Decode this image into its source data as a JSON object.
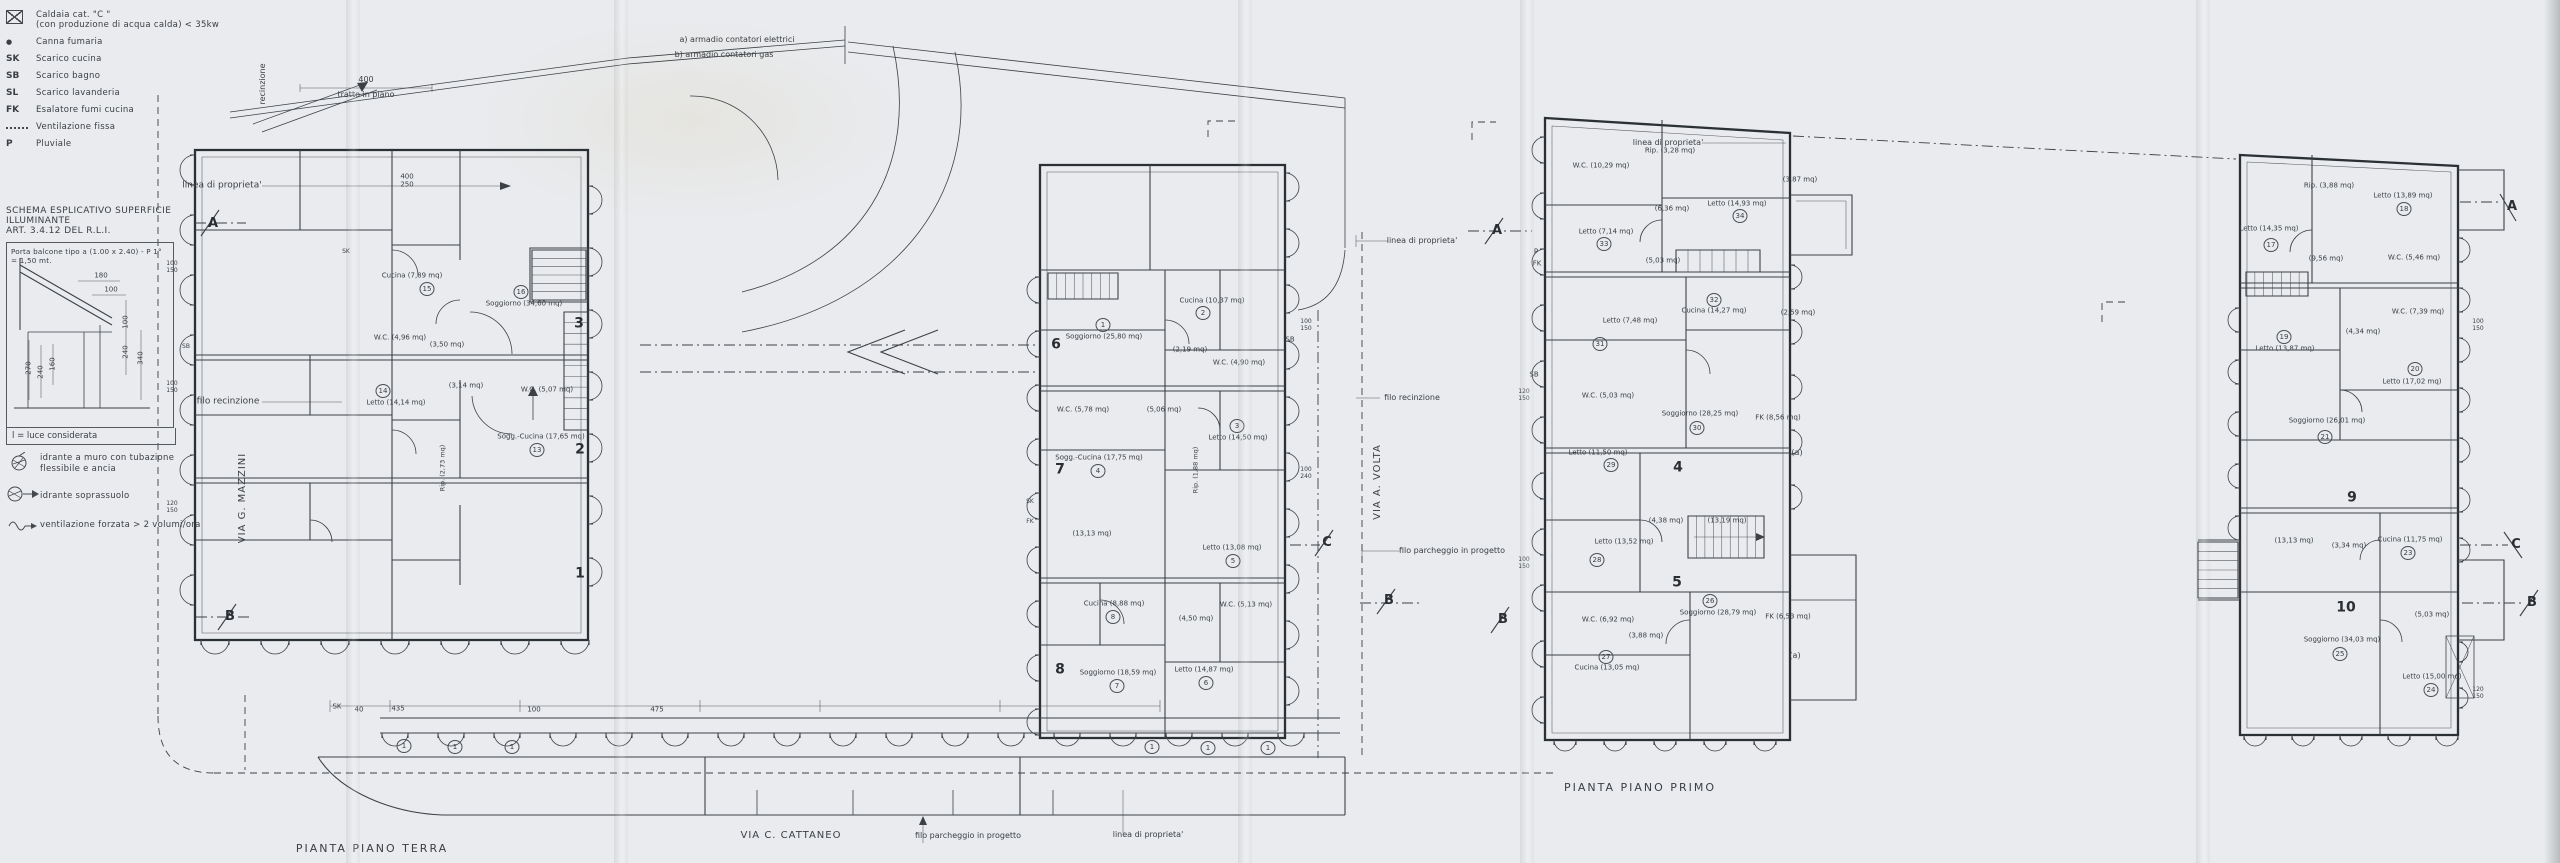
{
  "document": {
    "type": "scanned architectural floor plan drawing",
    "paper_color": "#e9ebee",
    "ink_color": "#3c4146"
  },
  "plan_titles": {
    "ground": "PIANTA PIANO TERRA",
    "first": "PIANTA PIANO PRIMO"
  },
  "legend": {
    "items": [
      {
        "icon": "boiler-box",
        "label": "Caldaia cat. \"C \"",
        "label2": "(con produzione di acqua calda) < 35kw"
      },
      {
        "icon": "flue-dot",
        "label": "Canna fumaria"
      },
      {
        "icon": "SK",
        "label": "Scarico cucina"
      },
      {
        "icon": "SB",
        "label": "Scarico bagno"
      },
      {
        "icon": "SL",
        "label": "Scarico lavanderia"
      },
      {
        "icon": "FK",
        "label": "Esalatore fumi cucina"
      },
      {
        "icon": "dotted-leader",
        "label": "Ventilazione fissa"
      },
      {
        "icon": "P",
        "label": "Pluviale"
      }
    ],
    "extras": [
      {
        "icon": "wall-hydrant",
        "label": "idrante a muro con tubazione",
        "label2": "flessibile e ancia"
      },
      {
        "icon": "ground-hydrant",
        "label": "idrante soprassuolo"
      },
      {
        "icon": "forced-vent",
        "label": "ventilazione forzata > 2 volumi/ora"
      }
    ]
  },
  "schema": {
    "title1": "SCHEMA ESPLICATIVO SUPERFICIE ILLUMINANTE",
    "title2": "ART. 3.4.12 DEL R.L.I.",
    "note1": "Porta balcone tipo a (1.00 x 2.40) - P 1°",
    "note2": "= 1,50 mt.",
    "caption": "l = luce considerata"
  },
  "labels": [
    {
      "t": "linea di proprieta'",
      "x": 222,
      "y": 186,
      "fs": 9,
      "n": "property-line-label"
    },
    {
      "t": "recinzione",
      "x": 263,
      "y": 84,
      "fs": 8,
      "r": -90
    },
    {
      "t": "400",
      "x": 366,
      "y": 80,
      "fs": 8
    },
    {
      "t": "tratto in piano",
      "x": 366,
      "y": 95,
      "fs": 8
    },
    {
      "t": "filo recinzione",
      "x": 228,
      "y": 402,
      "fs": 9,
      "n": "fence-line-label"
    },
    {
      "t": "VIA G. MAZZINI",
      "x": 243,
      "y": 498,
      "fs": 10,
      "r": -90,
      "sp": 1,
      "n": "street-label"
    },
    {
      "t": "A",
      "x": 213,
      "y": 224,
      "fs": 13,
      "b": 1,
      "n": "section-marker"
    },
    {
      "t": "B",
      "x": 230,
      "y": 617,
      "fs": 13,
      "b": 1,
      "n": "section-marker"
    },
    {
      "t": "PIANTA PIANO TERRA",
      "x": 372,
      "y": 849,
      "fs": 11,
      "sp": 2,
      "n": "plan-title-ground"
    },
    {
      "t": "VIA C. CATTANEO",
      "x": 791,
      "y": 836,
      "fs": 10,
      "sp": 1,
      "n": "street-label"
    },
    {
      "t": "filo parcheggio in progetto",
      "x": 968,
      "y": 836,
      "fs": 8
    },
    {
      "t": "linea di proprieta'",
      "x": 1148,
      "y": 835,
      "fs": 8
    },
    {
      "t": "a)  armadio contatori elettrici",
      "x": 737,
      "y": 40,
      "fs": 8,
      "n": "note-armadio-elettrici"
    },
    {
      "t": "b)  armadio contatori gas",
      "x": 724,
      "y": 55,
      "fs": 8,
      "n": "note-armadio-gas"
    },
    {
      "t": "400",
      "x": 407,
      "y": 177,
      "fs": 7
    },
    {
      "t": "250",
      "x": 407,
      "y": 185,
      "fs": 7
    },
    {
      "t": "SK",
      "x": 337,
      "y": 707,
      "fs": 7
    },
    {
      "t": "40",
      "x": 359,
      "y": 710,
      "fs": 7
    },
    {
      "t": "435",
      "x": 398,
      "y": 709,
      "fs": 7
    },
    {
      "t": "100",
      "x": 534,
      "y": 710,
      "fs": 7
    },
    {
      "t": "475",
      "x": 657,
      "y": 710,
      "fs": 7
    },
    {
      "t": "3",
      "x": 579,
      "y": 324,
      "fs": 14,
      "b": 1,
      "n": "unit-number"
    },
    {
      "t": "2",
      "x": 580,
      "y": 450,
      "fs": 14,
      "b": 1,
      "n": "unit-number"
    },
    {
      "t": "1",
      "x": 580,
      "y": 574,
      "fs": 14,
      "b": 1,
      "n": "unit-number"
    },
    {
      "t": "6",
      "x": 1056,
      "y": 345,
      "fs": 14,
      "b": 1,
      "n": "unit-number"
    },
    {
      "t": "7",
      "x": 1060,
      "y": 470,
      "fs": 14,
      "b": 1,
      "n": "unit-number"
    },
    {
      "t": "8",
      "x": 1060,
      "y": 670,
      "fs": 14,
      "b": 1,
      "n": "unit-number"
    },
    {
      "t": "4",
      "x": 1678,
      "y": 468,
      "fs": 14,
      "b": 1,
      "n": "unit-number"
    },
    {
      "t": "5",
      "x": 1677,
      "y": 583,
      "fs": 14,
      "b": 1,
      "n": "unit-number"
    },
    {
      "t": "9",
      "x": 2352,
      "y": 498,
      "fs": 14,
      "b": 1,
      "n": "unit-number"
    },
    {
      "t": "10",
      "x": 2346,
      "y": 608,
      "fs": 14,
      "b": 1,
      "n": "unit-number"
    },
    {
      "t": "Cucina (7,89 mq)",
      "x": 412,
      "y": 276,
      "fs": 7
    },
    {
      "t": "15",
      "x": 427,
      "y": 289,
      "ci": 1
    },
    {
      "t": "Soggiorno (34,60 mq)",
      "x": 524,
      "y": 304,
      "fs": 7
    },
    {
      "t": "16",
      "x": 521,
      "y": 292,
      "ci": 1
    },
    {
      "t": "W.C. (4,96 mq)",
      "x": 400,
      "y": 338,
      "fs": 7
    },
    {
      "t": "(3,50 mq)",
      "x": 447,
      "y": 345,
      "fs": 7
    },
    {
      "t": "Letto (14,14 mq)",
      "x": 396,
      "y": 403,
      "fs": 7
    },
    {
      "t": "14",
      "x": 383,
      "y": 391,
      "ci": 1
    },
    {
      "t": "(3,14 mq)",
      "x": 466,
      "y": 386,
      "fs": 7
    },
    {
      "t": "W.C. (5,07 mq)",
      "x": 547,
      "y": 390,
      "fs": 7
    },
    {
      "t": "Sogg.-Cucina (17,65 mq)",
      "x": 541,
      "y": 437,
      "fs": 7
    },
    {
      "t": "13",
      "x": 537,
      "y": 450,
      "ci": 1
    },
    {
      "t": "Rip. (2,73 mq)",
      "x": 443,
      "y": 468,
      "fs": 6.5,
      "r": -90
    },
    {
      "t": "Soggiorno (25,80 mq)",
      "x": 1104,
      "y": 337,
      "fs": 7
    },
    {
      "t": "1",
      "x": 1103,
      "y": 325,
      "ci": 1
    },
    {
      "t": "Cucina (10,37 mq)",
      "x": 1212,
      "y": 301,
      "fs": 7
    },
    {
      "t": "2",
      "x": 1203,
      "y": 313,
      "ci": 1
    },
    {
      "t": "(2,19 mq)",
      "x": 1190,
      "y": 350,
      "fs": 7
    },
    {
      "t": "W.C. (4,90 mq)",
      "x": 1239,
      "y": 363,
      "fs": 7
    },
    {
      "t": "W.C. (5,78 mq)",
      "x": 1083,
      "y": 410,
      "fs": 7
    },
    {
      "t": "(5,06 mq)",
      "x": 1164,
      "y": 410,
      "fs": 7
    },
    {
      "t": "Letto (14,50 mq)",
      "x": 1238,
      "y": 438,
      "fs": 7
    },
    {
      "t": "3",
      "x": 1237,
      "y": 426,
      "ci": 1
    },
    {
      "t": "Sogg.-Cucina (17,75 mq)",
      "x": 1099,
      "y": 458,
      "fs": 7
    },
    {
      "t": "4",
      "x": 1098,
      "y": 471,
      "ci": 1
    },
    {
      "t": "Rip. (1,88 mq)",
      "x": 1196,
      "y": 470,
      "fs": 6.5,
      "r": -90
    },
    {
      "t": "(13,13 mq)",
      "x": 1092,
      "y": 534,
      "fs": 7
    },
    {
      "t": "Letto (13,08 mq)",
      "x": 1232,
      "y": 548,
      "fs": 7
    },
    {
      "t": "5",
      "x": 1233,
      "y": 561,
      "ci": 1
    },
    {
      "t": "Cucina (8,88 mq)",
      "x": 1114,
      "y": 604,
      "fs": 7
    },
    {
      "t": "8",
      "x": 1113,
      "y": 617,
      "ci": 1
    },
    {
      "t": "W.C. (5,13 mq)",
      "x": 1246,
      "y": 605,
      "fs": 7
    },
    {
      "t": "(4,50 mq)",
      "x": 1196,
      "y": 619,
      "fs": 7
    },
    {
      "t": "Soggiorno (18,59 mq)",
      "x": 1118,
      "y": 673,
      "fs": 7
    },
    {
      "t": "7",
      "x": 1117,
      "y": 686,
      "ci": 1
    },
    {
      "t": "Letto (14,87 mq)",
      "x": 1204,
      "y": 670,
      "fs": 7
    },
    {
      "t": "6",
      "x": 1206,
      "y": 683,
      "ci": 1
    },
    {
      "t": "W.C. (10,29 mq)",
      "x": 1601,
      "y": 166,
      "fs": 7
    },
    {
      "t": "Rip. (3,28 mq)",
      "x": 1670,
      "y": 151,
      "fs": 7
    },
    {
      "t": "Letto (14,93 mq)",
      "x": 1737,
      "y": 204,
      "fs": 7
    },
    {
      "t": "34",
      "x": 1740,
      "y": 216,
      "ci": 1
    },
    {
      "t": "Letto (7,14 mq)",
      "x": 1606,
      "y": 232,
      "fs": 7
    },
    {
      "t": "33",
      "x": 1604,
      "y": 244,
      "ci": 1
    },
    {
      "t": "(6,36 mq)",
      "x": 1672,
      "y": 209,
      "fs": 7
    },
    {
      "t": "(3,87 mq)",
      "x": 1800,
      "y": 180,
      "fs": 7
    },
    {
      "t": "(5,03 mq)",
      "x": 1663,
      "y": 261,
      "fs": 7
    },
    {
      "t": "Letto (7,48 mq)",
      "x": 1630,
      "y": 321,
      "fs": 7
    },
    {
      "t": "31",
      "x": 1600,
      "y": 344,
      "ci": 1
    },
    {
      "t": "Cucina (14,27 mq)",
      "x": 1714,
      "y": 311,
      "fs": 7
    },
    {
      "t": "32",
      "x": 1714,
      "y": 300,
      "ci": 1
    },
    {
      "t": "(2,59 mq)",
      "x": 1798,
      "y": 313,
      "fs": 7
    },
    {
      "t": "Soggiorno (28,25 mq)",
      "x": 1700,
      "y": 414,
      "fs": 7
    },
    {
      "t": "30",
      "x": 1697,
      "y": 428,
      "ci": 1
    },
    {
      "t": "W.C. (5,03 mq)",
      "x": 1608,
      "y": 396,
      "fs": 7
    },
    {
      "t": "FK (8,56 mq)",
      "x": 1778,
      "y": 418,
      "fs": 7
    },
    {
      "t": "Letto (11,50 mq)",
      "x": 1598,
      "y": 453,
      "fs": 7
    },
    {
      "t": "29",
      "x": 1611,
      "y": 465,
      "ci": 1
    },
    {
      "t": "Letto (13,52 mq)",
      "x": 1624,
      "y": 542,
      "fs": 7
    },
    {
      "t": "28",
      "x": 1597,
      "y": 560,
      "ci": 1
    },
    {
      "t": "(13,19 mq)",
      "x": 1727,
      "y": 521,
      "fs": 7
    },
    {
      "t": "(4,38 mq)",
      "x": 1666,
      "y": 521,
      "fs": 7
    },
    {
      "t": "Soggiorno (28,79 mq)",
      "x": 1718,
      "y": 613,
      "fs": 7
    },
    {
      "t": "26",
      "x": 1710,
      "y": 601,
      "ci": 1
    },
    {
      "t": "W.C. (6,92 mq)",
      "x": 1608,
      "y": 620,
      "fs": 7
    },
    {
      "t": "(3,88 mq)",
      "x": 1646,
      "y": 636,
      "fs": 7
    },
    {
      "t": "Cucina (13,05 mq)",
      "x": 1607,
      "y": 668,
      "fs": 7
    },
    {
      "t": "27",
      "x": 1606,
      "y": 657,
      "ci": 1
    },
    {
      "t": "FK (6,53 mq)",
      "x": 1788,
      "y": 617,
      "fs": 7
    },
    {
      "t": "(a)",
      "x": 1797,
      "y": 453,
      "fs": 8
    },
    {
      "t": "(a)",
      "x": 1795,
      "y": 656,
      "fs": 8
    },
    {
      "t": "Letto (14,35 mq)",
      "x": 2269,
      "y": 229,
      "fs": 7
    },
    {
      "t": "17",
      "x": 2271,
      "y": 245,
      "ci": 1
    },
    {
      "t": "Rip. (3,88 mq)",
      "x": 2329,
      "y": 186,
      "fs": 7
    },
    {
      "t": "Letto (13,89 mq)",
      "x": 2403,
      "y": 196,
      "fs": 7
    },
    {
      "t": "18",
      "x": 2404,
      "y": 209,
      "ci": 1
    },
    {
      "t": "W.C. (5,46 mq)",
      "x": 2414,
      "y": 258,
      "fs": 7
    },
    {
      "t": "(9,56 mq)",
      "x": 2326,
      "y": 259,
      "fs": 7
    },
    {
      "t": "Letto (13,87 mq)",
      "x": 2285,
      "y": 349,
      "fs": 7
    },
    {
      "t": "19",
      "x": 2284,
      "y": 337,
      "ci": 1
    },
    {
      "t": "W.C. (7,39 mq)",
      "x": 2418,
      "y": 312,
      "fs": 7
    },
    {
      "t": "(4,34 mq)",
      "x": 2363,
      "y": 332,
      "fs": 7
    },
    {
      "t": "Letto (17,02 mq)",
      "x": 2412,
      "y": 382,
      "fs": 7
    },
    {
      "t": "20",
      "x": 2415,
      "y": 369,
      "ci": 1
    },
    {
      "t": "Soggiorno (26,01 mq)",
      "x": 2327,
      "y": 421,
      "fs": 7
    },
    {
      "t": "21",
      "x": 2325,
      "y": 437,
      "ci": 1
    },
    {
      "t": "Cucina (11,75 mq)",
      "x": 2410,
      "y": 540,
      "fs": 7
    },
    {
      "t": "23",
      "x": 2408,
      "y": 553,
      "ci": 1
    },
    {
      "t": "(3,34 mq)",
      "x": 2349,
      "y": 546,
      "fs": 7
    },
    {
      "t": "(13,13 mq)",
      "x": 2294,
      "y": 541,
      "fs": 7
    },
    {
      "t": "Soggiorno (34,03 mq)",
      "x": 2342,
      "y": 640,
      "fs": 7
    },
    {
      "t": "25",
      "x": 2340,
      "y": 654,
      "ci": 1
    },
    {
      "t": "(5,03 mq)",
      "x": 2432,
      "y": 615,
      "fs": 7
    },
    {
      "t": "Letto (15,00 mq)",
      "x": 2432,
      "y": 677,
      "fs": 7
    },
    {
      "t": "24",
      "x": 2431,
      "y": 690,
      "ci": 1
    },
    {
      "t": "linea di proprieta'",
      "x": 1422,
      "y": 241,
      "fs": 8
    },
    {
      "t": "filo recinzione",
      "x": 1412,
      "y": 398,
      "fs": 8
    },
    {
      "t": "VIA A. VOLTA",
      "x": 1378,
      "y": 482,
      "fs": 10,
      "r": -90,
      "sp": 1,
      "n": "street-label"
    },
    {
      "t": "filo parcheggio in progetto",
      "x": 1452,
      "y": 551,
      "fs": 8
    },
    {
      "t": "linea di proprieta'",
      "x": 1668,
      "y": 143,
      "fs": 8
    },
    {
      "t": "A",
      "x": 1497,
      "y": 231,
      "fs": 13,
      "b": 1,
      "n": "section-marker"
    },
    {
      "t": "B",
      "x": 1389,
      "y": 601,
      "fs": 13,
      "b": 1,
      "n": "section-marker"
    },
    {
      "t": "B",
      "x": 1503,
      "y": 620,
      "fs": 13,
      "b": 1,
      "n": "section-marker"
    },
    {
      "t": "C",
      "x": 1327,
      "y": 543,
      "fs": 13,
      "b": 1,
      "n": "section-marker"
    },
    {
      "t": "A",
      "x": 2512,
      "y": 207,
      "fs": 13,
      "b": 1,
      "n": "section-marker"
    },
    {
      "t": "C",
      "x": 2516,
      "y": 545,
      "fs": 13,
      "b": 1,
      "n": "section-marker"
    },
    {
      "t": "B",
      "x": 2532,
      "y": 603,
      "fs": 13,
      "b": 1,
      "n": "section-marker"
    },
    {
      "t": "PIANTA PIANO PRIMO",
      "x": 1640,
      "y": 788,
      "fs": 11,
      "sp": 2,
      "n": "plan-title-first"
    },
    {
      "t": "P",
      "x": 1536,
      "y": 252,
      "fs": 7
    },
    {
      "t": "FK",
      "x": 1537,
      "y": 264,
      "fs": 7
    },
    {
      "t": "SB",
      "x": 1534,
      "y": 375,
      "fs": 7
    },
    {
      "t": "SB",
      "x": 1290,
      "y": 340,
      "fs": 7
    },
    {
      "t": "SK",
      "x": 346,
      "y": 252,
      "fs": 6
    },
    {
      "t": "SB",
      "x": 186,
      "y": 347,
      "fs": 6
    },
    {
      "t": "SK",
      "x": 1030,
      "y": 502,
      "fs": 6
    },
    {
      "t": "FK",
      "x": 1030,
      "y": 522,
      "fs": 6
    },
    {
      "t": "100",
      "x": 172,
      "y": 264,
      "fs": 6
    },
    {
      "t": "150",
      "x": 172,
      "y": 271,
      "fs": 6
    },
    {
      "t": "100",
      "x": 172,
      "y": 384,
      "fs": 6
    },
    {
      "t": "150",
      "x": 172,
      "y": 391,
      "fs": 6
    },
    {
      "t": "120",
      "x": 172,
      "y": 504,
      "fs": 6
    },
    {
      "t": "150",
      "x": 172,
      "y": 511,
      "fs": 6
    },
    {
      "t": "100",
      "x": 1306,
      "y": 322,
      "fs": 6
    },
    {
      "t": "150",
      "x": 1306,
      "y": 329,
      "fs": 6
    },
    {
      "t": "100",
      "x": 1306,
      "y": 470,
      "fs": 6
    },
    {
      "t": "240",
      "x": 1306,
      "y": 477,
      "fs": 6
    },
    {
      "t": "120",
      "x": 1524,
      "y": 392,
      "fs": 6
    },
    {
      "t": "150",
      "x": 1524,
      "y": 399,
      "fs": 6
    },
    {
      "t": "100",
      "x": 1524,
      "y": 560,
      "fs": 6
    },
    {
      "t": "150",
      "x": 1524,
      "y": 567,
      "fs": 6
    },
    {
      "t": "100",
      "x": 2478,
      "y": 322,
      "fs": 6
    },
    {
      "t": "150",
      "x": 2478,
      "y": 329,
      "fs": 6
    },
    {
      "t": "120",
      "x": 2478,
      "y": 690,
      "fs": 6
    },
    {
      "t": "150",
      "x": 2478,
      "y": 697,
      "fs": 6
    },
    {
      "t": "1",
      "x": 404,
      "y": 746,
      "ci": 1
    },
    {
      "t": "1",
      "x": 455,
      "y": 747,
      "ci": 1
    },
    {
      "t": "1",
      "x": 512,
      "y": 747,
      "ci": 1
    },
    {
      "t": "1",
      "x": 1152,
      "y": 747,
      "ci": 1
    },
    {
      "t": "1",
      "x": 1208,
      "y": 748,
      "ci": 1
    },
    {
      "t": "1",
      "x": 1268,
      "y": 748,
      "ci": 1
    },
    {
      "t": "180",
      "x": 101,
      "y": 276,
      "fs": 7
    },
    {
      "t": "100",
      "x": 111,
      "y": 290,
      "fs": 7
    },
    {
      "t": "270",
      "x": 29,
      "y": 368,
      "fs": 7,
      "r": -90
    },
    {
      "t": "240",
      "x": 41,
      "y": 372,
      "fs": 7,
      "r": -90
    },
    {
      "t": "160",
      "x": 53,
      "y": 364,
      "fs": 7,
      "r": -90
    },
    {
      "t": "240",
      "x": 126,
      "y": 352,
      "fs": 7,
      "r": -90
    },
    {
      "t": "100",
      "x": 126,
      "y": 322,
      "fs": 7,
      "r": -90
    },
    {
      "t": "340",
      "x": 141,
      "y": 358,
      "fs": 7,
      "r": -90
    }
  ]
}
